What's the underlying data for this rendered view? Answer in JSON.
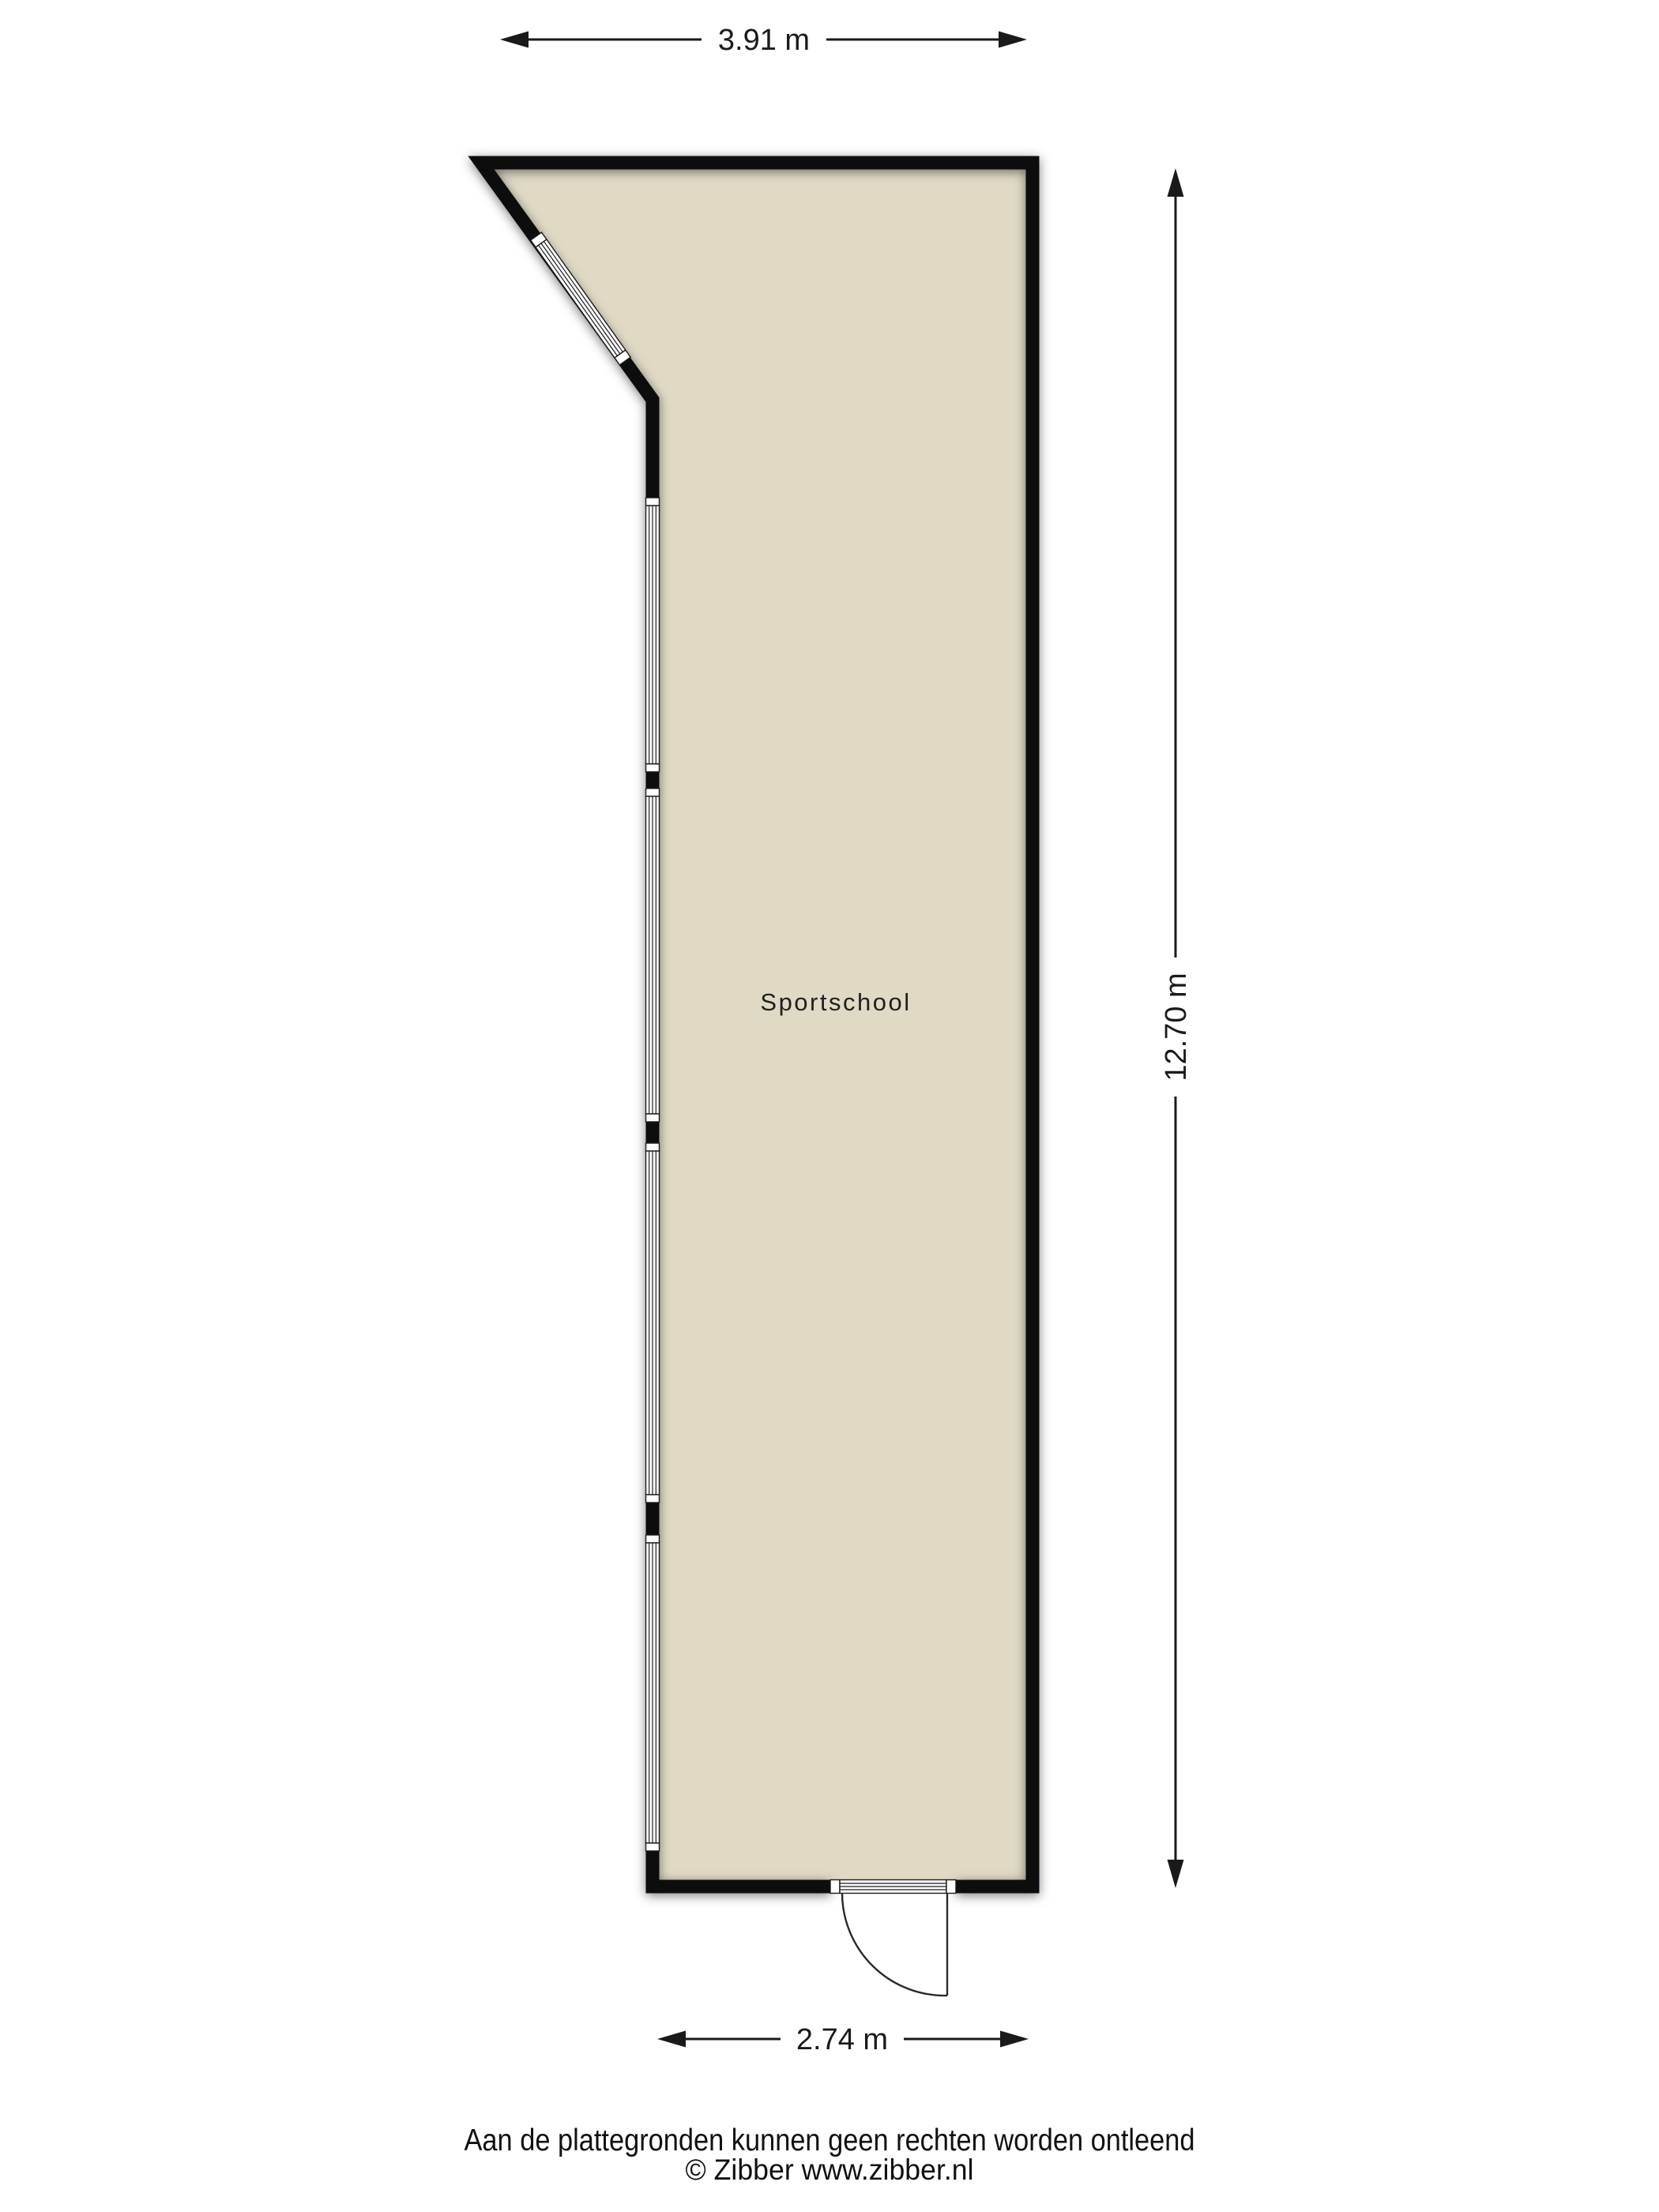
{
  "plan": {
    "room_label": "Sportschool",
    "dimensions": {
      "top": "3.91 m",
      "right": "12.70 m",
      "bottom": "2.74 m"
    },
    "colors": {
      "floor": "#e0dac5",
      "wall": "#0d0d0d",
      "background": "#ffffff"
    }
  },
  "footer": {
    "disclaimer": "Aan de plattegronden kunnen geen rechten worden ontleend",
    "copyright": "© Zibber www.zibber.nl"
  }
}
